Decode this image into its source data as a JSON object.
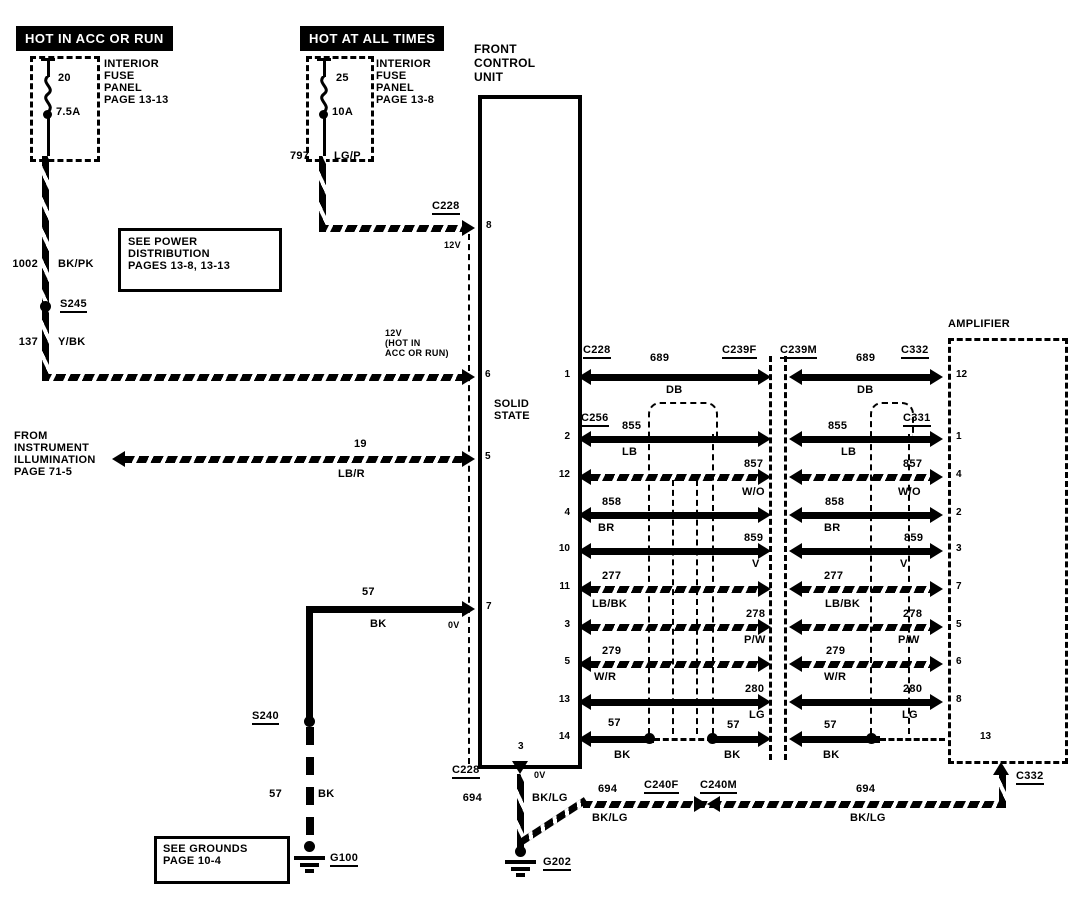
{
  "banners": {
    "left": "HOT IN ACC OR RUN",
    "right": "HOT AT ALL TIMES"
  },
  "fuses": {
    "left": {
      "value_top": "20",
      "value_bottom": "7.5A",
      "label": "INTERIOR\nFUSE\nPANEL\nPAGE  13-13"
    },
    "right": {
      "value_top": "25",
      "value_bottom": "10A",
      "label": "INTERIOR\nFUSE\nPANEL\nPAGE  13-8"
    }
  },
  "notes": {
    "power": "SEE  POWER\nDISTRIBUTION\nPAGES  13-8,  13-13",
    "grounds": "SEE  GROUNDS\nPAGE  10-4",
    "illumination": "FROM\nINSTRUMENT\nILLUMINATION\nPAGE  71-5"
  },
  "fcu": {
    "title": "FRONT\nCONTROL\nUNIT",
    "body": "SOLID\nSTATE",
    "top_connector": "C228",
    "top_pin": "8",
    "top_volt": "12V",
    "pin6": "6",
    "pin6_note": "12V\n(HOT IN\nACC OR RUN)",
    "pin5": "5",
    "pin7": "7",
    "pin7_volt": "0V",
    "bottom_connector": "C228",
    "bottom_pin": "3",
    "bottom_volt": "0V"
  },
  "amplifier": {
    "title": "AMPLIFIER",
    "bottom_pin": "13",
    "bottom_connector": "C332"
  },
  "feeds": {
    "left": {
      "circuit_upper": "1002",
      "color_upper": "BK/PK",
      "splice": "S245",
      "circuit_lower": "137",
      "color_lower": "Y/BK"
    },
    "right": {
      "circuit": "797",
      "color": "LG/P"
    },
    "illumination": {
      "circuit": "19",
      "color": "LB/R"
    }
  },
  "grounds": {
    "left": {
      "circuit_upper": "57",
      "color_upper": "BK",
      "splice": "S240",
      "circuit_lower": "57",
      "color_lower": "BK",
      "id": "G100"
    },
    "center": {
      "circuit": "694",
      "color": "BK/LG",
      "id": "G202"
    },
    "run": {
      "circuit_left": "694",
      "color_left": "BK/LG",
      "conn_f": "C240F",
      "conn_m": "C240M",
      "circuit_right": "694",
      "color_right": "BK/LG",
      "end_connector": "C332"
    }
  },
  "harness_rows": [
    {
      "left_connector": "C228",
      "circuit_left": "689",
      "color_left": "DB",
      "mid_connector_f": "C239F",
      "mid_connector_m": "C239M",
      "circuit_right": "689",
      "color_right": "DB",
      "right_connector": "C332",
      "fcu_pin": "1",
      "amp_pin": "12",
      "style": "solid"
    },
    {
      "left_connector": "C256",
      "circuit_left": "855",
      "color_left": "LB",
      "circuit_right": "855",
      "color_right": "LB",
      "right_connector": "C331",
      "fcu_pin": "2",
      "amp_pin": "1",
      "style": "solid"
    },
    {
      "circuit_left": "857",
      "color_left": "W/O",
      "circuit_right": "857",
      "color_right": "W/O",
      "fcu_pin": "12",
      "amp_pin": "4",
      "style": "hatched"
    },
    {
      "circuit_left": "858",
      "color_left": "BR",
      "circuit_right": "858",
      "color_right": "BR",
      "fcu_pin": "4",
      "amp_pin": "2",
      "style": "solid"
    },
    {
      "circuit_left": "859",
      "color_left": "V",
      "circuit_right": "859",
      "color_right": "V",
      "fcu_pin": "10",
      "amp_pin": "3",
      "style": "solid"
    },
    {
      "circuit_left": "277",
      "color_left": "LB/BK",
      "circuit_right": "277",
      "color_right": "LB/BK",
      "fcu_pin": "11",
      "amp_pin": "7",
      "style": "hatched"
    },
    {
      "circuit_left": "278",
      "color_left": "P/W",
      "circuit_right": "278",
      "color_right": "P/W",
      "fcu_pin": "3",
      "amp_pin": "5",
      "style": "hatched"
    },
    {
      "circuit_left": "279",
      "color_left": "W/R",
      "circuit_right": "279",
      "color_right": "W/R",
      "fcu_pin": "5",
      "amp_pin": "6",
      "style": "hatched"
    },
    {
      "circuit_left": "280",
      "color_left": "LG",
      "circuit_right": "280",
      "color_right": "LG",
      "fcu_pin": "13",
      "amp_pin": "8",
      "style": "solid"
    },
    {
      "circuit_left": "57",
      "color_left": "BK",
      "circuit_mid": "57",
      "color_mid": "BK",
      "circuit_right": "57",
      "color_right": "BK",
      "fcu_pin": "14",
      "style": "solid"
    }
  ]
}
